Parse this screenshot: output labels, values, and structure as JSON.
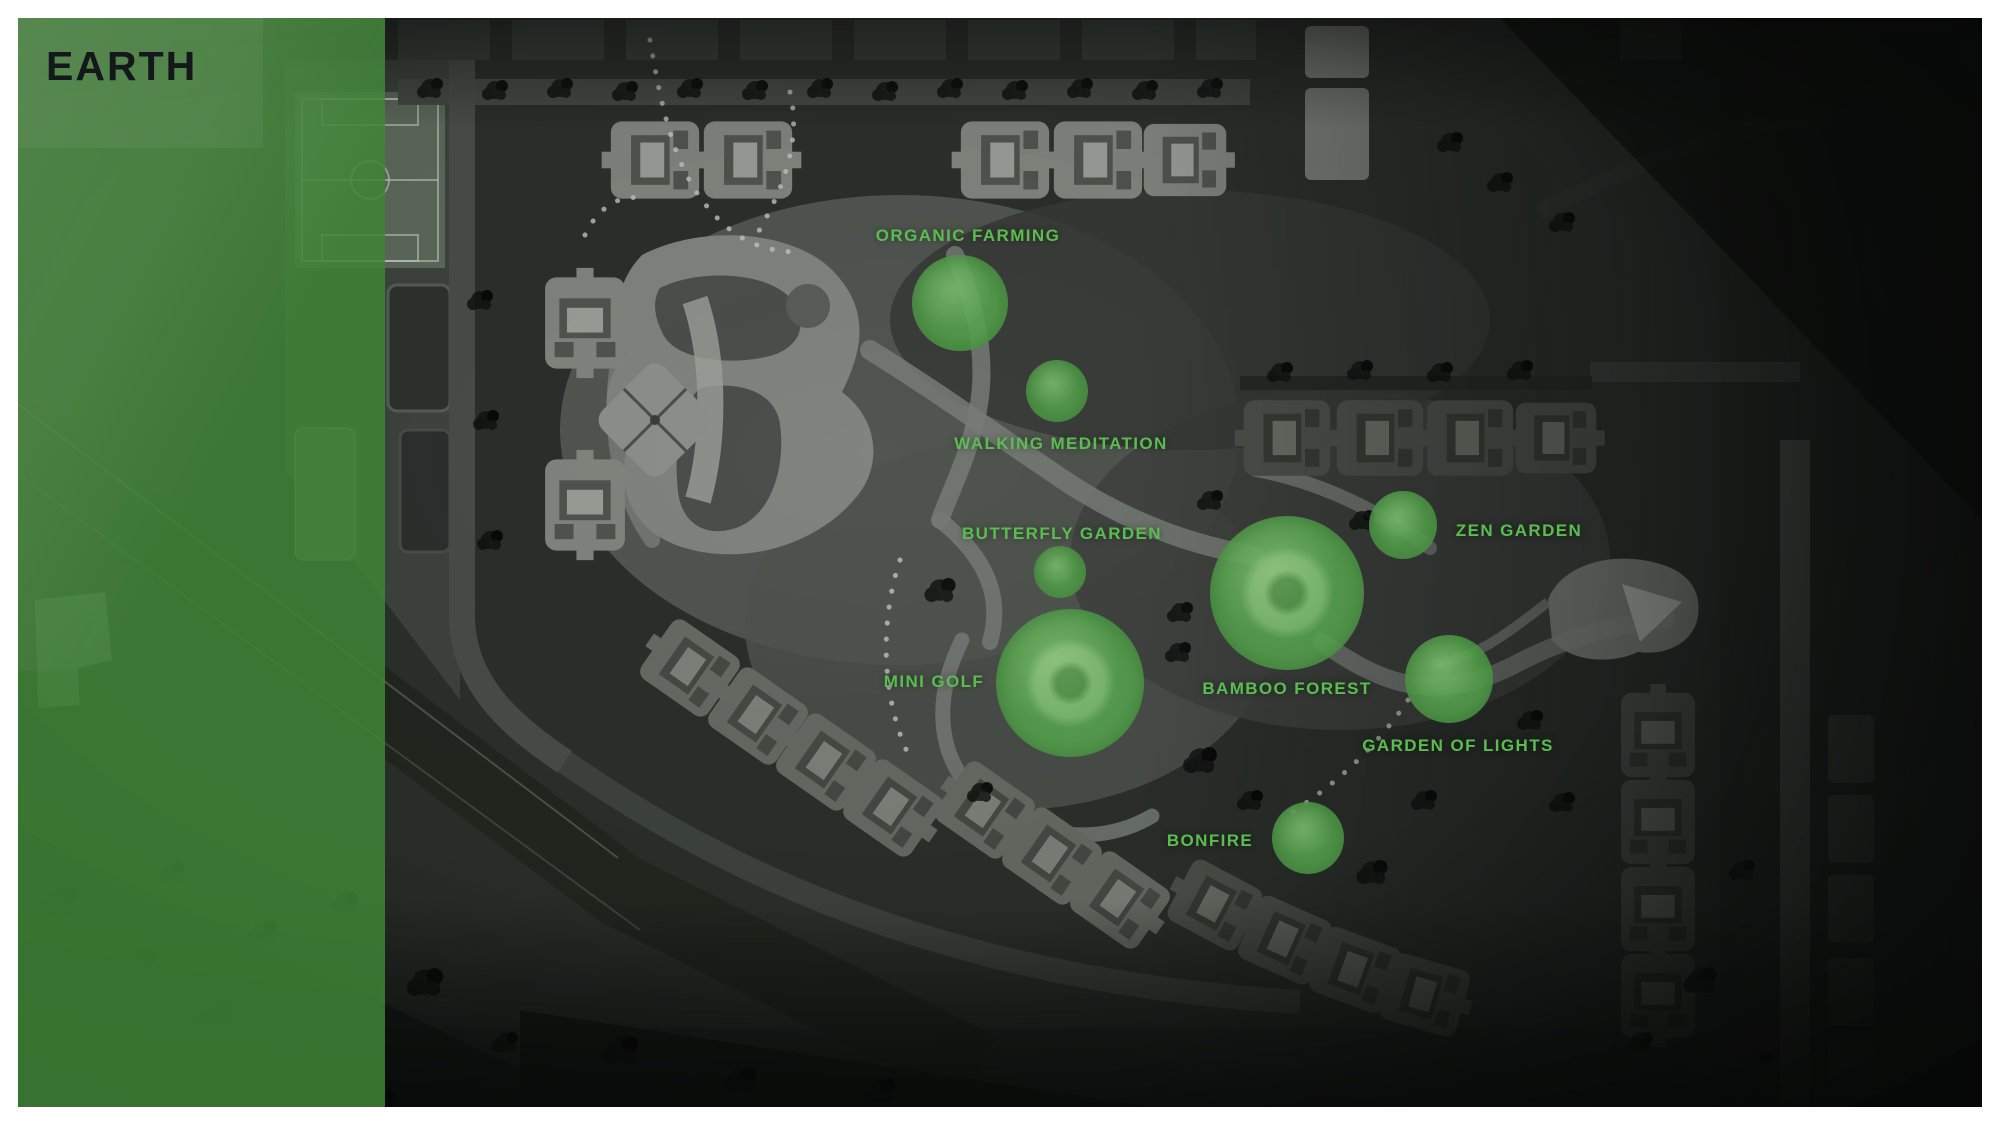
{
  "title": "EARTH",
  "theme": {
    "accent_green": "#5abd4f",
    "panel_green": "#3f7d3a",
    "circle_green": "#55a34d",
    "frame_white": "#ffffff",
    "map_dark": "#20231f"
  },
  "amenities": [
    {
      "id": "organic-farming",
      "label": "ORGANIC FARMING",
      "label_x": 968,
      "label_y": 236,
      "circle": {
        "cx": 960,
        "cy": 303,
        "r": 48
      }
    },
    {
      "id": "walking-meditation",
      "label": "WALKING MEDITATION",
      "label_x": 1061,
      "label_y": 444,
      "circle": {
        "cx": 1057,
        "cy": 391,
        "r": 31
      }
    },
    {
      "id": "butterfly-garden",
      "label": "BUTTERFLY GARDEN",
      "label_x": 1062,
      "label_y": 534,
      "circle": {
        "cx": 1060,
        "cy": 572,
        "r": 26
      }
    },
    {
      "id": "zen-garden",
      "label": "ZEN GARDEN",
      "label_x": 1519,
      "label_y": 531,
      "circle": {
        "cx": 1403,
        "cy": 525,
        "r": 34
      }
    },
    {
      "id": "mini-golf",
      "label": "MINI GOLF",
      "label_x": 934,
      "label_y": 682,
      "circle": {
        "cx": 1070,
        "cy": 683,
        "r": 74
      }
    },
    {
      "id": "bamboo-forest",
      "label": "BAMBOO FOREST",
      "label_x": 1287,
      "label_y": 689,
      "circle": {
        "cx": 1287,
        "cy": 593,
        "r": 77
      }
    },
    {
      "id": "garden-of-lights",
      "label": "GARDEN OF LIGHTS",
      "label_x": 1458,
      "label_y": 746,
      "circle": {
        "cx": 1449,
        "cy": 679,
        "r": 44
      }
    },
    {
      "id": "bonfire",
      "label": "BONFIRE",
      "label_x": 1210,
      "label_y": 841,
      "circle": {
        "cx": 1308,
        "cy": 838,
        "r": 36
      }
    }
  ]
}
